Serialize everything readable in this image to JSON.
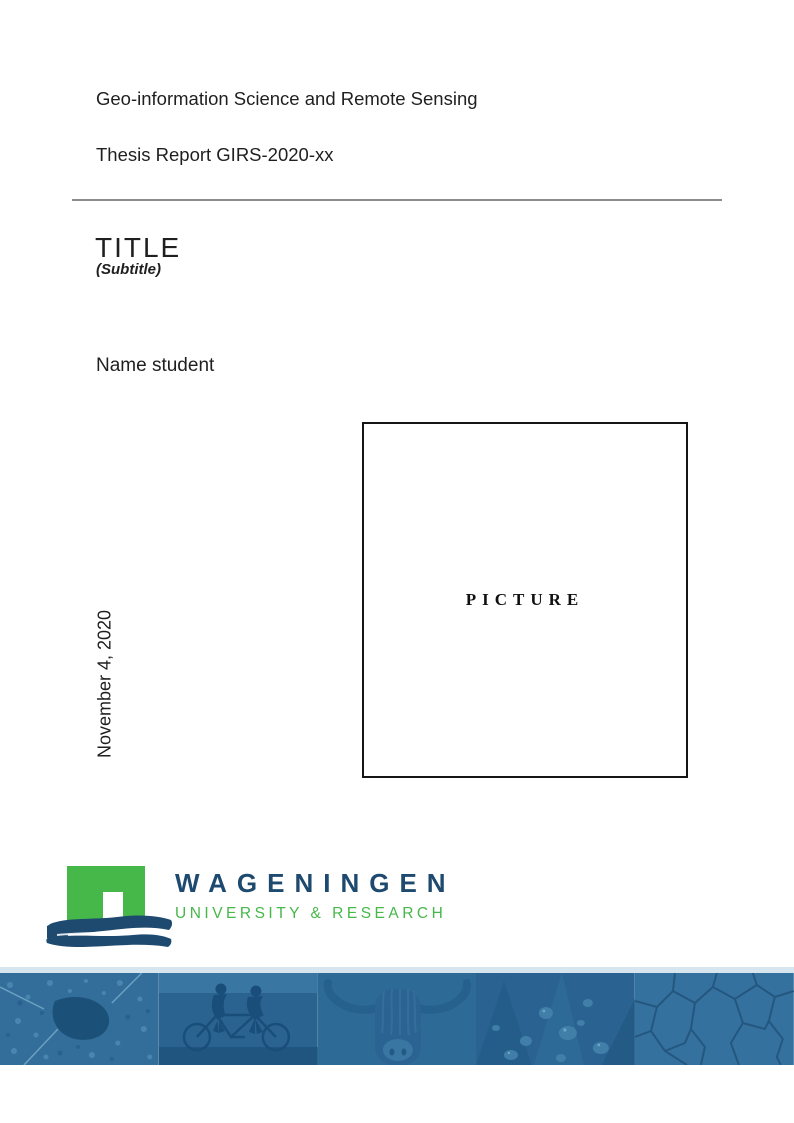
{
  "document": {
    "program": "Geo-information Science and Remote Sensing",
    "report": "Thesis Report GIRS-2020-xx",
    "title": "TITLE",
    "subtitle": "(Subtitle)",
    "author": "Name student",
    "date": "November 4, 2020",
    "picture_placeholder": "PICTURE"
  },
  "logo": {
    "wordmark": "WAGENINGEN",
    "tagline": "UNIVERSITY & RESEARCH"
  },
  "colors": {
    "logo_green": "#46b749",
    "logo_blue": "#1d4a6e",
    "banner_tint": "#2e6a96",
    "text": "#1f1f1f",
    "rule_gray": "#8c8c8c"
  },
  "banner": {
    "tiles": [
      "aerial-landscape",
      "tandem-cyclists",
      "highland-cow",
      "petals-with-droplets",
      "cracked-earth"
    ]
  }
}
